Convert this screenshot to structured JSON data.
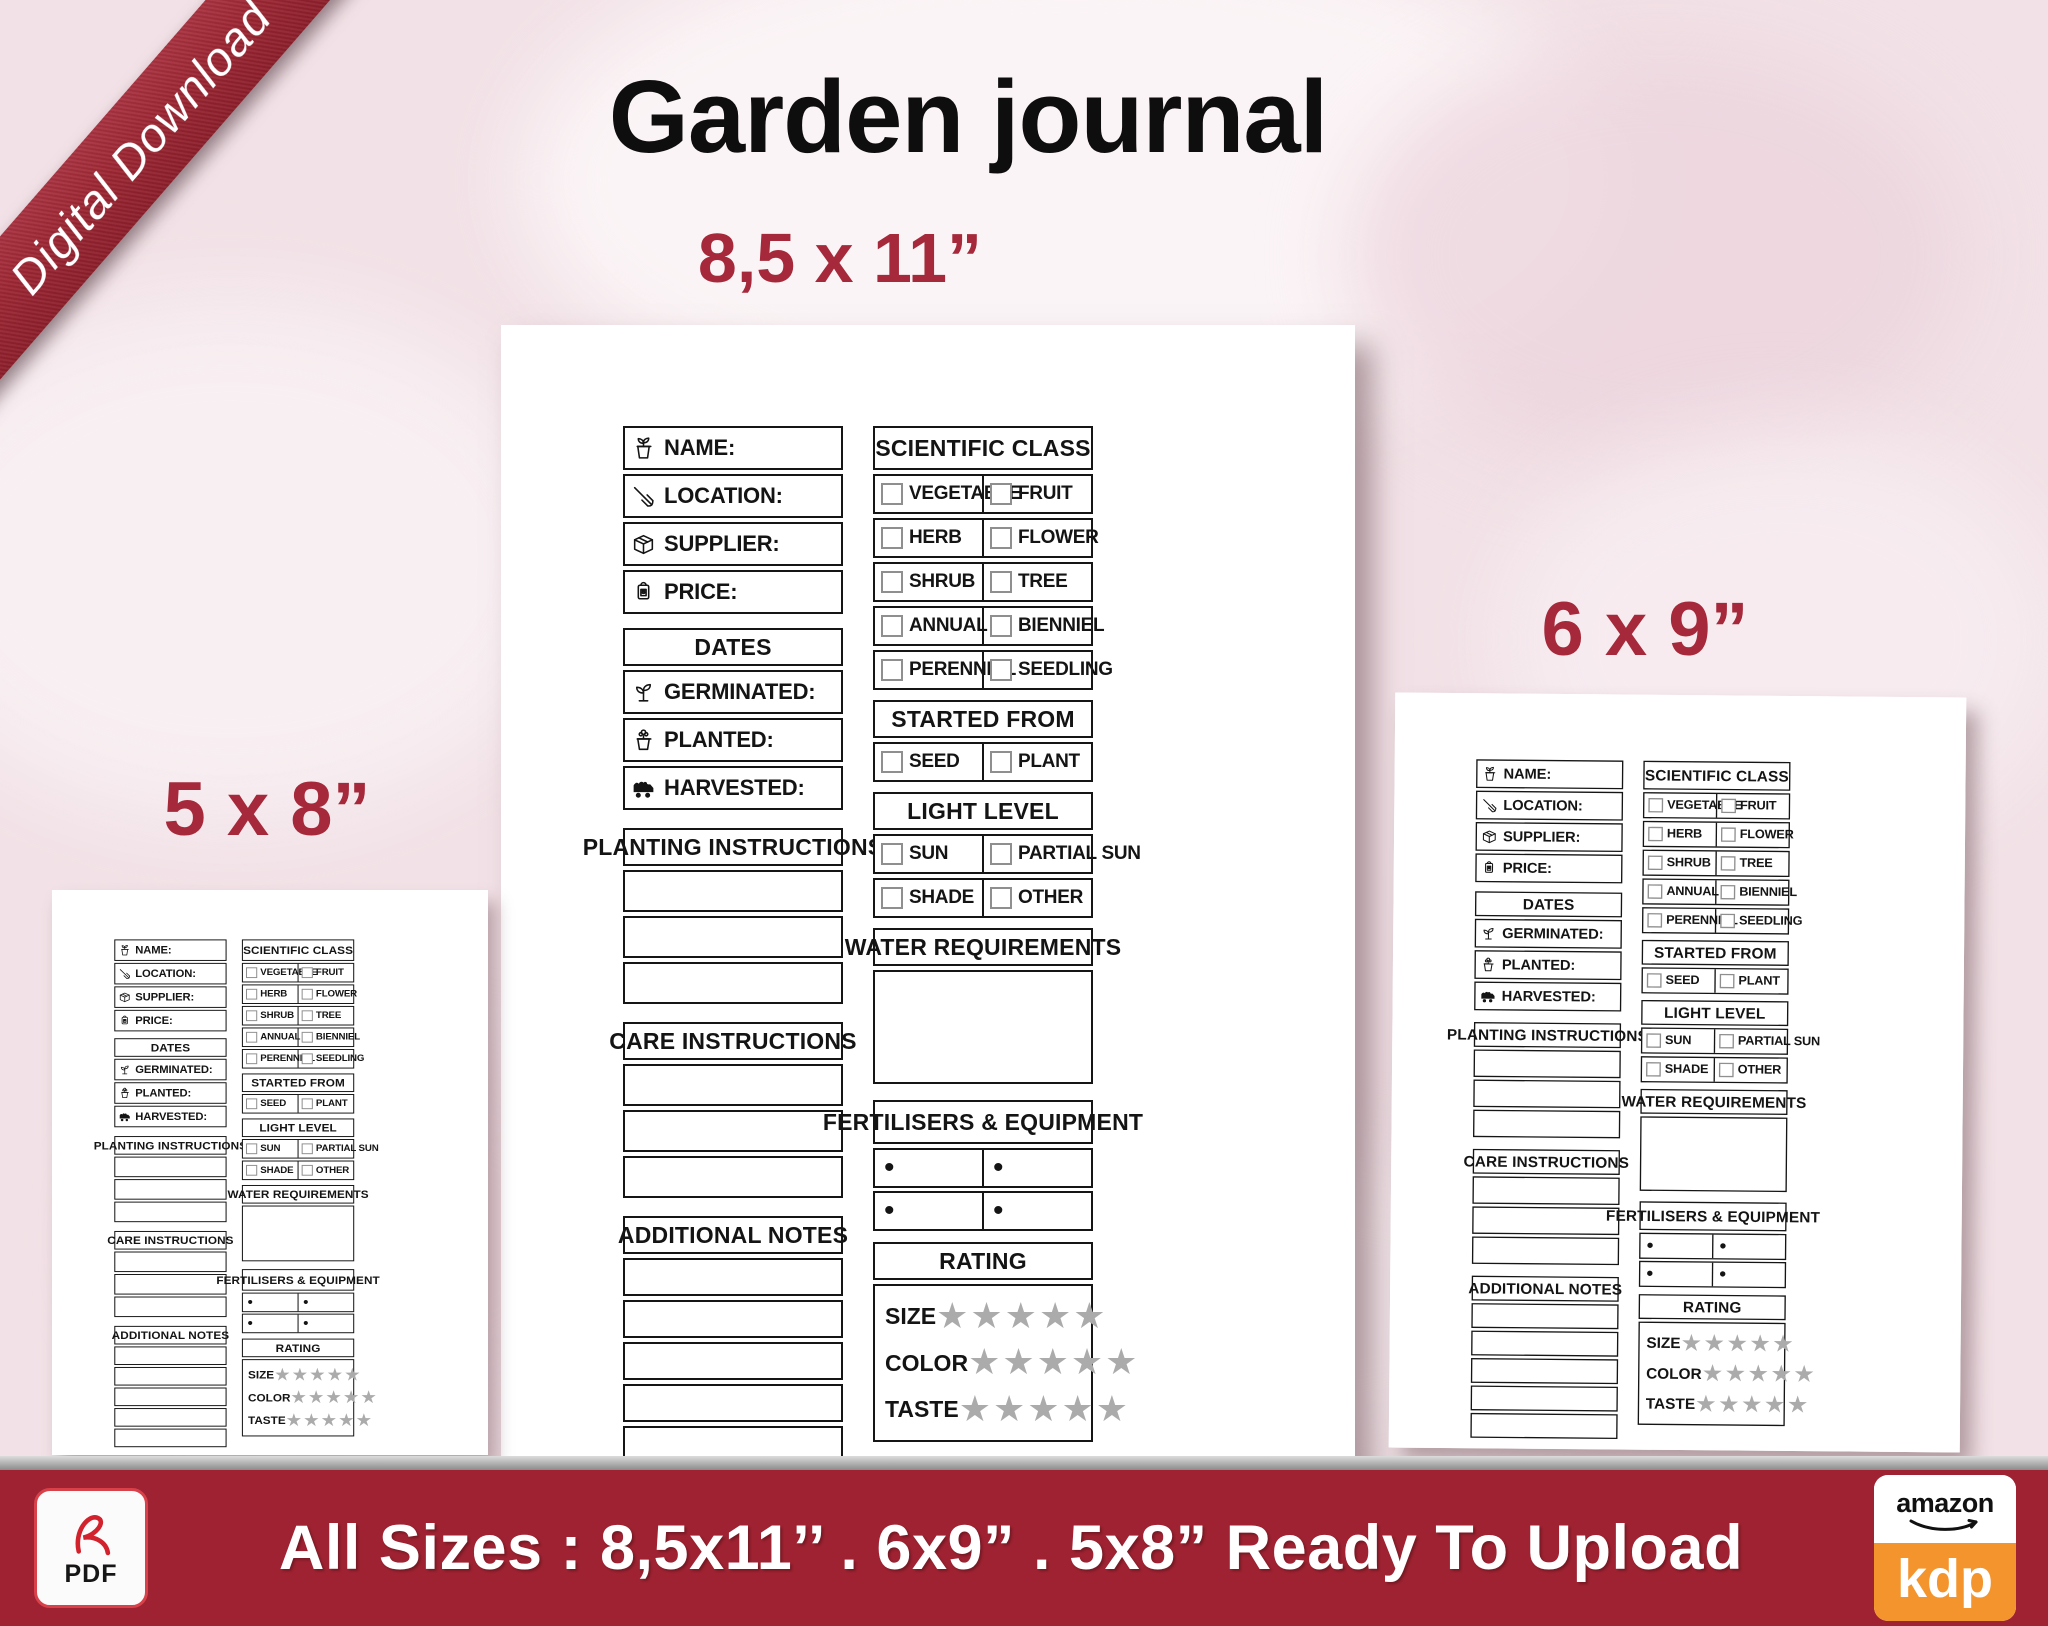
{
  "ribbon": {
    "label": "Digital Download"
  },
  "header": {
    "title": "Garden journal"
  },
  "sizes": {
    "large": "8,5 x 11”",
    "medium": "6 x 9”",
    "small": "5 x 8”"
  },
  "page": {
    "fields": {
      "name": "NAME:",
      "location": "LOCATION:",
      "supplier": "SUPPLIER:",
      "price": "PRICE:"
    },
    "dates": {
      "header": "DATES",
      "germinated": "GERMINATED:",
      "planted": "PLANTED:",
      "harvested": "HARVESTED:"
    },
    "planting_header": "PLANTING INSTRUCTIONS",
    "care_header": "CARE INSTRUCTIONS",
    "notes_header": "ADDITIONAL NOTES",
    "scientific": {
      "header": "SCIENTIFIC CLASS",
      "opts": [
        "VEGETABLE",
        "FRUIT",
        "HERB",
        "FLOWER",
        "SHRUB",
        "TREE",
        "ANNUAL",
        "BIENNIEL",
        "PERENNIAL",
        "SEEDLING"
      ]
    },
    "started": {
      "header": "STARTED FROM",
      "opts": [
        "SEED",
        "PLANT"
      ]
    },
    "light": {
      "header": "LIGHT LEVEL",
      "opts": [
        "SUN",
        "PARTIAL SUN",
        "SHADE",
        "OTHER"
      ]
    },
    "water_header": "WATER REQUIREMENTS",
    "fert_header": "FERTILISERS & EQUIPMENT",
    "bullet": "•",
    "rating": {
      "header": "RATING",
      "size": "SIZE",
      "color": "COLOR",
      "taste": "TASTE",
      "stars": "★★★★★"
    }
  },
  "footer": {
    "pdf_label": "PDF",
    "text": "All Sizes :  8,5x11’’ . 6x9” . 5x8”  Ready To Upload",
    "kdp_brand": "amazon",
    "kdp_product": "kdp"
  },
  "colors": {
    "accent_red": "#A5293A",
    "banner_red": "#9E2231",
    "kdp_orange": "#F3942C",
    "star_gray": "#ABABAB"
  }
}
